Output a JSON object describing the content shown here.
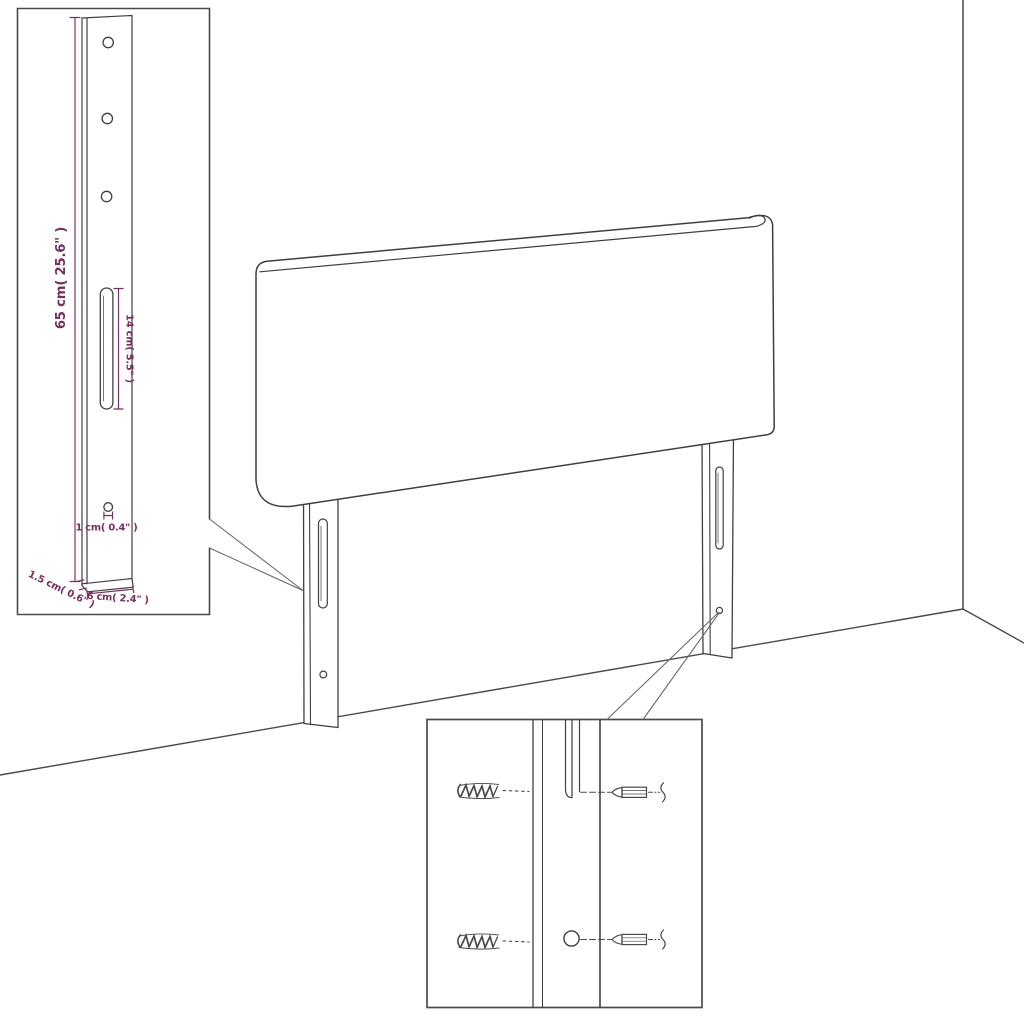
{
  "diagram": {
    "kind": "furniture-assembly-dimension-diagram",
    "subject": "upholstered headboard with two slotted mounting legs, shown in a room corner",
    "colors": {
      "dimension_text": "#7c2b5e",
      "outline": "#3f3f3f",
      "background": "#ffffff"
    },
    "leg_detail_inset": {
      "dimensions": {
        "leg_height": "65 cm( 25.6\" )",
        "slot_length": "14 cm( 5.5\" )",
        "hole_diameter": "1 cm( 0.4\" )",
        "leg_thickness": "1.5 cm( 0.6\" )",
        "leg_width": "6 cm( 2.4\" )"
      }
    }
  }
}
